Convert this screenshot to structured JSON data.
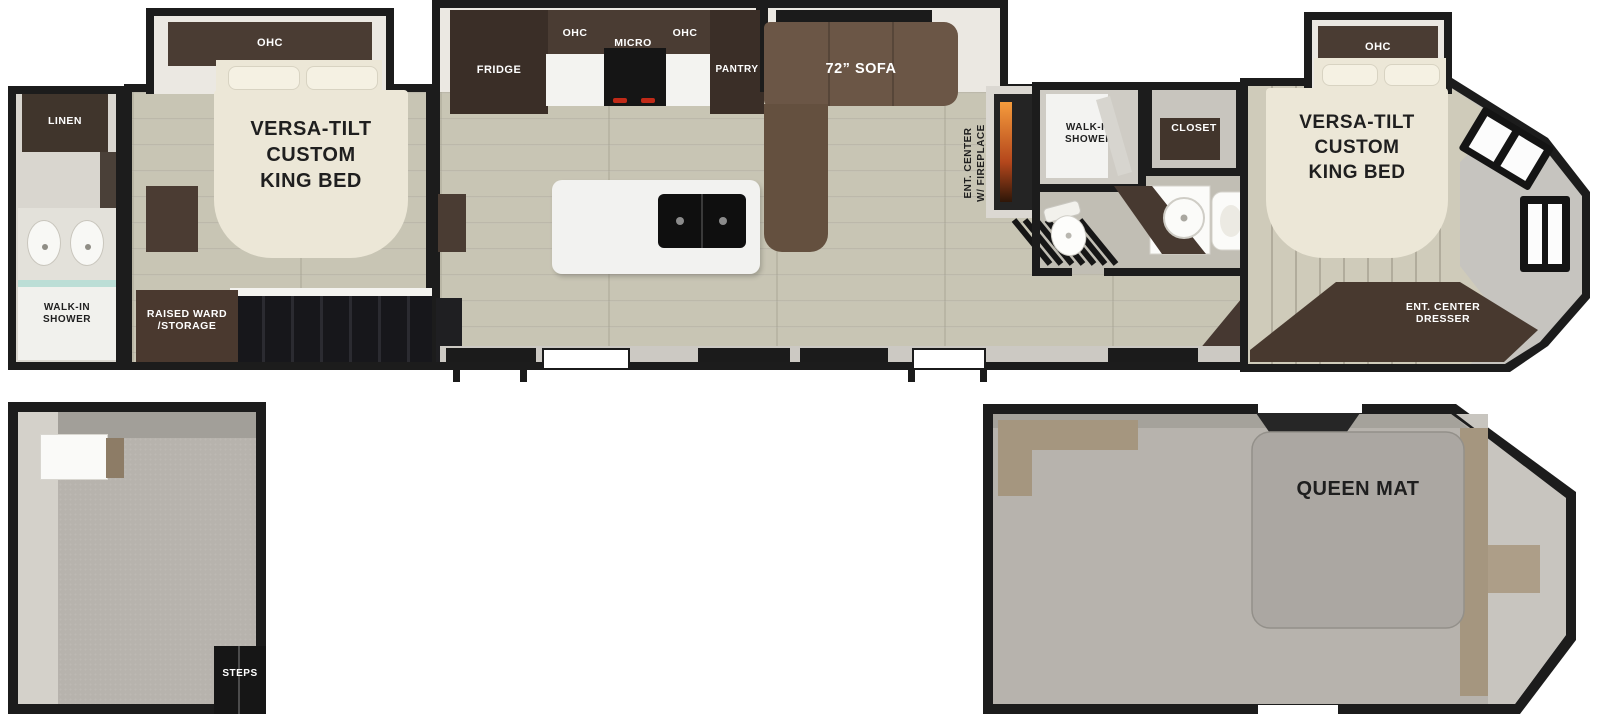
{
  "fp": {
    "rear_bath": {
      "linen": "LINEN",
      "shower_lines": [
        "WALK-IN",
        "SHOWER"
      ]
    },
    "rear_bedroom": {
      "ohc": "OHC",
      "bed_lines": [
        "VERSA-TILT",
        "CUSTOM",
        "KING BED"
      ],
      "ward_lines": [
        "RAISED WARD",
        "/STORAGE"
      ]
    },
    "kitchen": {
      "fridge": "FRIDGE",
      "ohc1": "OHC",
      "micro": "MICRO",
      "ohc2": "OHC",
      "pantry": "PANTRY"
    },
    "living": {
      "sofa": "72” SOFA",
      "ent_lines": [
        "ENT. CENTER",
        "W/ FIREPLACE"
      ]
    },
    "mid_bath": {
      "shower_lines": [
        "WALK-IN",
        "SHOWER"
      ],
      "closet": "CLOSET"
    },
    "front_bedroom": {
      "ohc": "OHC",
      "bed_lines": [
        "VERSA-TILT",
        "CUSTOM",
        "KING BED"
      ],
      "dresser_lines": [
        "ENT. CENTER",
        "DRESSER"
      ]
    },
    "rear_loft": {
      "steps": "STEPS"
    },
    "front_loft": {
      "queen_mat": "QUEEN MAT"
    }
  },
  "colors": {
    "wall": "#1c1c1c",
    "cabinet_dark": "#4a3c33",
    "cabinet_darker": "#3a2e27",
    "sofa": "#6b5646",
    "floor_plank": "#c8c5b4",
    "bed_cream": "#ece7d7",
    "loft_carpet": "#b7b3ad",
    "fireplace_glow": "#f59b3c",
    "island_white": "#f2f2f0"
  }
}
